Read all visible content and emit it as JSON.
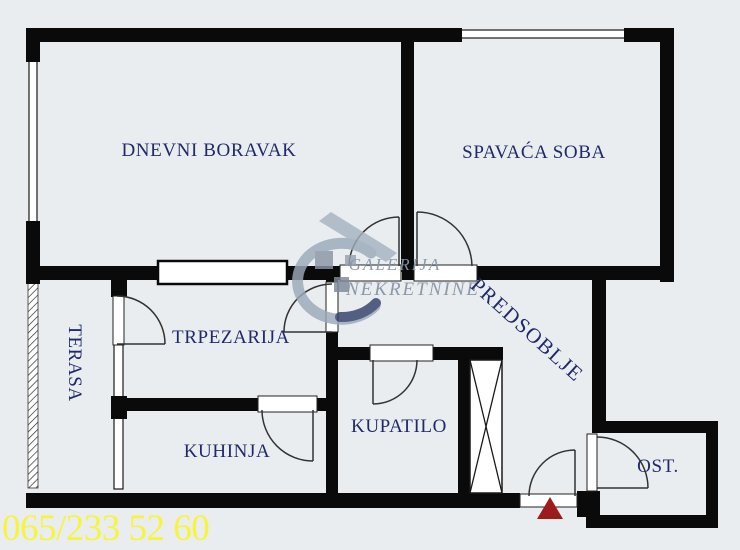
{
  "title": "apartment-floor-plan",
  "rooms": {
    "living_room": "DNEVNI BORAVAK",
    "bedroom": "SPAVAĆA SOBA",
    "dining_room": "TRPEZARIJA",
    "terrace": "TERASA",
    "kitchen": "KUHINJA",
    "bathroom": "KUPATILO",
    "hallway": "PREDSOBLJE",
    "storage": "OST."
  },
  "watermark": {
    "line1": "GALERIJA",
    "line2": "NEKRETNINE"
  },
  "footer": {
    "phone": "065/233 52 60"
  },
  "colors": {
    "background": "#eaedef",
    "wall": "#0a0a0a",
    "room_label": "#20296a",
    "watermark_gray": "#8795a5",
    "watermark_dark_swoosh": "#32406b",
    "phone_yellow": "#f7f43e",
    "entrance_marker_red": "#9e1b1b"
  }
}
